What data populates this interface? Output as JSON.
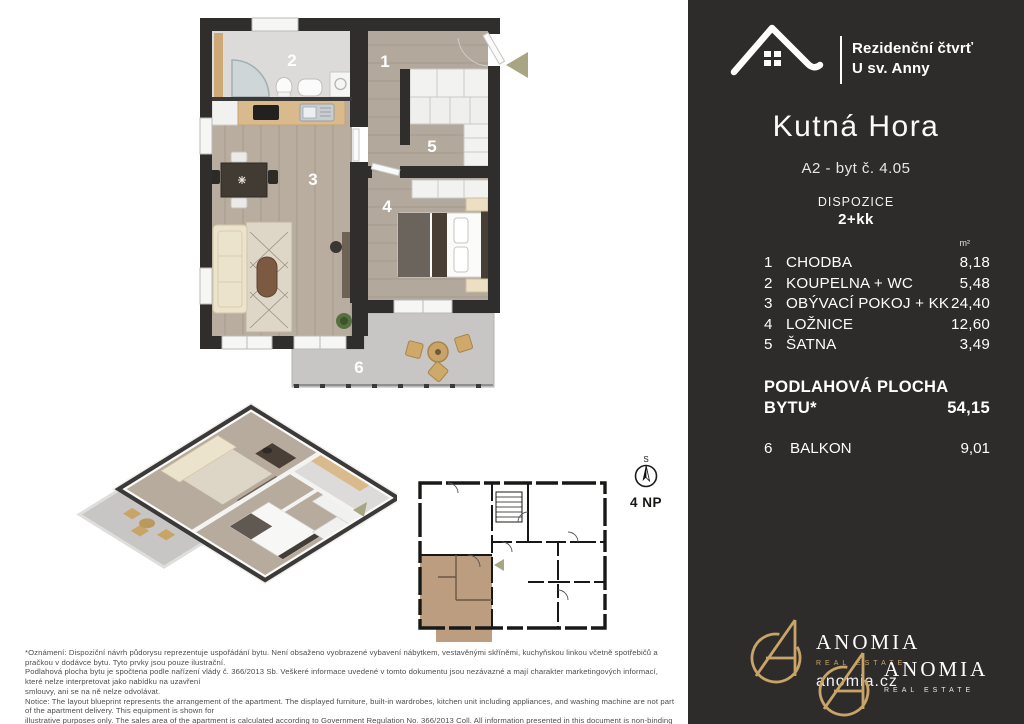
{
  "header": {
    "project_line1": "Rezidenční čtvrť",
    "project_line2": "U sv. Anny",
    "city": "Kutná Hora",
    "unit": "A2 - byt č. 4.05",
    "layout_label": "DISPOZICE",
    "layout_value": "2+kk"
  },
  "rooms": {
    "unit_header": "m²",
    "list": [
      {
        "num": "1",
        "name": "CHODBA",
        "area": "8,18"
      },
      {
        "num": "2",
        "name": "KOUPELNA + WC",
        "area": "5,48"
      },
      {
        "num": "3",
        "name": "OBÝVACÍ POKOJ + KK",
        "area": "24,40"
      },
      {
        "num": "4",
        "name": "LOŽNICE",
        "area": "12,60"
      },
      {
        "num": "5",
        "name": "ŠATNA",
        "area": "3,49"
      }
    ],
    "total_label_line1": "PODLAHOVÁ PLOCHA",
    "total_label_line2": "BYTU*",
    "total_value": "54,15",
    "balcony": {
      "num": "6",
      "name": "BALKON",
      "area": "9,01"
    }
  },
  "floorplan_labels": {
    "hall": "1",
    "bath": "2",
    "living": "3",
    "bedroom": "4",
    "closet": "5",
    "balcony": "6"
  },
  "compass": {
    "north": "S",
    "floor": "4 NP"
  },
  "brand_footer": {
    "name": "ANOMIA",
    "tagline": "REAL ESTATE",
    "website": "anomia.cz"
  },
  "disclaimer": {
    "cz1": "*Oznámení: Dispoziční návrh půdorysu reprezentuje uspořádání bytu. Není obsaženo vyobrazené vybavení nábytkem, vestavěnými skříněmi, kuchyňskou linkou včetně spotřebičů a pračkou v dodávce bytu. Tyto prvky jsou pouze ilustrační.",
    "cz2": "Podlahová plocha bytu je spočtena podle nařízení vlády č. 366/2013 Sb. Veškeré informace uvedené v tomto dokumentu jsou nezávazné a mají charakter marketingových informací, které nelze interpretovat jako nabídku na uzavření",
    "cz3": "smlouvy, ani se na ně nelze odvolávat.",
    "en1": "Notice: The layout blueprint represents the arrangement of the apartment. The displayed furniture, built-in wardrobes, kitchen unit including appliances, and washing machine are not part of the apartment delivery. This equipment is shown for",
    "en2": "illustrative purposes only. The sales area of the apartment is calculated according to Government Regulation No. 366/2013 Coll. All information presented in this document is non-binding and constitutes general marketing information, which",
    "en3": "should not be construed as an offer to enter into a contract, nor can it be invoked as such."
  },
  "colors": {
    "panel_bg": "#2d2c2b",
    "gold": "#c9a468",
    "wall": "#2f2e2d",
    "wood_floor": "#b7ab9e",
    "bath_floor": "#dcdbd9",
    "balcony_floor": "#c7c6c4",
    "kitchen_counter": "#d9ba8c",
    "blueprint_highlight": "#bd9d80",
    "arrow_olive": "#a8a583"
  }
}
